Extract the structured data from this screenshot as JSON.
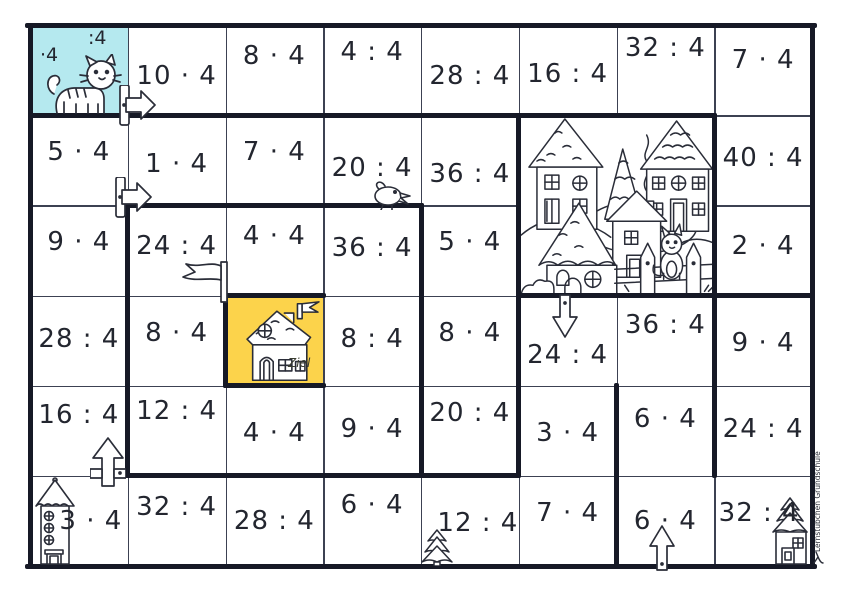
{
  "board": {
    "left": 30,
    "top": 25,
    "cols": 8,
    "rows": 6,
    "cell_w": 97.75,
    "cell_h": 90.1667
  },
  "colors": {
    "start_bg": "#b5e9ef",
    "goal_bg": "#fcd34b",
    "grid_line": "#3c4152",
    "wall": "#161926",
    "ink": "#23262f"
  },
  "start": {
    "mul_label": "·4",
    "div_label": ":4"
  },
  "ziel": {
    "label": "Ziel"
  },
  "credit": {
    "text": "Lernstübchen Grundschule"
  },
  "cells": [
    {
      "r": 1,
      "c": 2,
      "t": "10 · 4",
      "dx": 0,
      "dy": 6
    },
    {
      "r": 1,
      "c": 3,
      "t": "8 · 4",
      "dx": 0,
      "dy": -14
    },
    {
      "r": 1,
      "c": 4,
      "t": "4 : 4",
      "dx": 0,
      "dy": -18
    },
    {
      "r": 1,
      "c": 5,
      "t": "28 : 4",
      "dx": 0,
      "dy": 6
    },
    {
      "r": 1,
      "c": 6,
      "t": "16 : 4",
      "dx": 0,
      "dy": 4
    },
    {
      "r": 1,
      "c": 7,
      "t": "32 : 4",
      "dx": 0,
      "dy": -22
    },
    {
      "r": 1,
      "c": 8,
      "t": "7 · 4",
      "dx": 0,
      "dy": -10
    },
    {
      "r": 2,
      "c": 1,
      "t": "5 · 4",
      "dx": 0,
      "dy": -8
    },
    {
      "r": 2,
      "c": 2,
      "t": "1 · 4",
      "dx": 0,
      "dy": 4
    },
    {
      "r": 2,
      "c": 3,
      "t": "7 · 4",
      "dx": 0,
      "dy": -8
    },
    {
      "r": 2,
      "c": 4,
      "t": "20 : 4",
      "dx": 0,
      "dy": 8
    },
    {
      "r": 2,
      "c": 5,
      "t": "36 : 4",
      "dx": 0,
      "dy": 14
    },
    {
      "r": 2,
      "c": 8,
      "t": "40 : 4",
      "dx": 0,
      "dy": -2
    },
    {
      "r": 3,
      "c": 1,
      "t": "9 · 4",
      "dx": 0,
      "dy": -8
    },
    {
      "r": 3,
      "c": 2,
      "t": "24 : 4",
      "dx": 0,
      "dy": -4
    },
    {
      "r": 3,
      "c": 3,
      "t": "4 · 4",
      "dx": 0,
      "dy": -14
    },
    {
      "r": 3,
      "c": 4,
      "t": "36 : 4",
      "dx": 0,
      "dy": -2
    },
    {
      "r": 3,
      "c": 5,
      "t": "5 · 4",
      "dx": 0,
      "dy": -8
    },
    {
      "r": 3,
      "c": 8,
      "t": "2 · 4",
      "dx": 0,
      "dy": -4
    },
    {
      "r": 4,
      "c": 1,
      "t": "28 : 4",
      "dx": 0,
      "dy": -2
    },
    {
      "r": 4,
      "c": 2,
      "t": "8 · 4",
      "dx": 0,
      "dy": -8
    },
    {
      "r": 4,
      "c": 4,
      "t": "8 : 4",
      "dx": 0,
      "dy": -2
    },
    {
      "r": 4,
      "c": 5,
      "t": "8 · 4",
      "dx": 0,
      "dy": -8
    },
    {
      "r": 4,
      "c": 6,
      "t": "24 : 4",
      "dx": 0,
      "dy": 14
    },
    {
      "r": 4,
      "c": 7,
      "t": "36 : 4",
      "dx": 0,
      "dy": -16
    },
    {
      "r": 4,
      "c": 8,
      "t": "9 · 4",
      "dx": 0,
      "dy": 2
    },
    {
      "r": 5,
      "c": 1,
      "t": "16 : 4",
      "dx": 0,
      "dy": -16
    },
    {
      "r": 5,
      "c": 2,
      "t": "12 : 4",
      "dx": 0,
      "dy": -20
    },
    {
      "r": 5,
      "c": 3,
      "t": "4 · 4",
      "dx": 0,
      "dy": 2
    },
    {
      "r": 5,
      "c": 4,
      "t": "9 · 4",
      "dx": 0,
      "dy": -2
    },
    {
      "r": 5,
      "c": 5,
      "t": "20 : 4",
      "dx": 0,
      "dy": -18
    },
    {
      "r": 5,
      "c": 6,
      "t": "3 · 4",
      "dx": 0,
      "dy": 2
    },
    {
      "r": 5,
      "c": 7,
      "t": "6 · 4",
      "dx": 0,
      "dy": -12
    },
    {
      "r": 5,
      "c": 8,
      "t": "24 : 4",
      "dx": 0,
      "dy": -2
    },
    {
      "r": 6,
      "c": 1,
      "t": "3 · 4",
      "dx": 12,
      "dy": 0
    },
    {
      "r": 6,
      "c": 2,
      "t": "32 : 4",
      "dx": 0,
      "dy": -14
    },
    {
      "r": 6,
      "c": 3,
      "t": "28 : 4",
      "dx": 0,
      "dy": 0
    },
    {
      "r": 6,
      "c": 4,
      "t": "6 · 4",
      "dx": 0,
      "dy": -16
    },
    {
      "r": 6,
      "c": 5,
      "t": "12 : 4",
      "dx": 8,
      "dy": 2
    },
    {
      "r": 6,
      "c": 6,
      "t": "7 · 4",
      "dx": 0,
      "dy": -8
    },
    {
      "r": 6,
      "c": 7,
      "t": "6 · 4",
      "dx": 0,
      "dy": 0
    },
    {
      "r": 6,
      "c": 8,
      "t": "32 : 4",
      "dx": -4,
      "dy": -8
    }
  ],
  "maze": {
    "h_walls": [
      [
        25,
        27.5,
        814.5
      ],
      [
        115.17,
        30,
        714.25
      ],
      [
        205.33,
        127.75,
        421
      ],
      [
        295.5,
        225.5,
        323.25
      ],
      [
        295.5,
        518.75,
        812
      ],
      [
        385.67,
        225.5,
        323.25
      ],
      [
        475.83,
        127.75,
        518.75
      ],
      [
        566,
        27.5,
        814.5
      ]
    ],
    "v_walls": [
      [
        30,
        25,
        566
      ],
      [
        812,
        25,
        566
      ],
      [
        127.75,
        205.33,
        475.83
      ],
      [
        225.5,
        295.5,
        385.67
      ],
      [
        421,
        205.33,
        475.83
      ],
      [
        518.75,
        115.17,
        475.83
      ],
      [
        616.5,
        385.67,
        566
      ],
      [
        714.25,
        115.17,
        475.83
      ]
    ]
  },
  "decorations": {
    "start_cat": "striped cat in start cell",
    "signposts": "right-pointing arrow signposts on walls",
    "bird": "bird standing on wall",
    "goal_flag": "pennant flag at goal corner",
    "village": "village with houses, trees, fence and cat",
    "goal_house": "house with flag in yellow goal cell",
    "tower": "tall tower bottom left",
    "tree": "small fir tree bottom",
    "corner_house": "small house bottom right",
    "arrows": "block arrows marking passage direction"
  }
}
